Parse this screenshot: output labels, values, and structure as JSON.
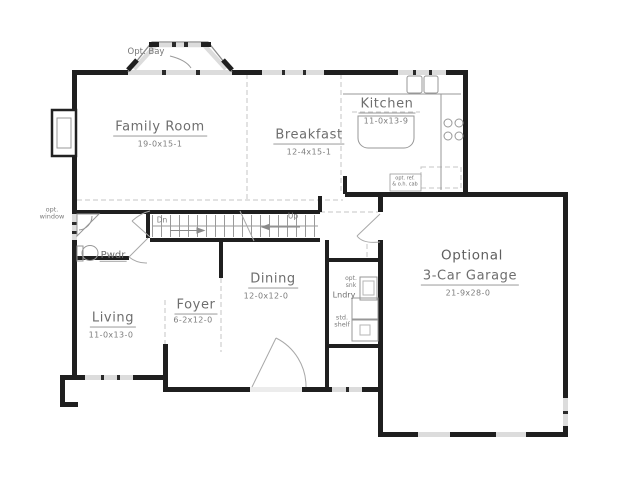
{
  "plan": {
    "rooms": {
      "family": {
        "name": "Family Room",
        "dims": "19-0x15-1"
      },
      "breakfast": {
        "name": "Breakfast",
        "dims": "12-4x15-1"
      },
      "kitchen": {
        "name": "Kitchen",
        "dims": "11-0x13-9"
      },
      "dining": {
        "name": "Dining",
        "dims": "12-0x12-0"
      },
      "living": {
        "name": "Living",
        "dims": "11-0x13-0"
      },
      "foyer": {
        "name": "Foyer",
        "dims": "6-2x12-0"
      },
      "powder": {
        "name": "Pwdr"
      },
      "laundry": {
        "name": "Lndry"
      },
      "garage": {
        "prefix": "Optional",
        "name": "3-Car Garage",
        "dims": "21-9x28-0"
      }
    },
    "annotations": {
      "opt_bay": "Opt. Bay",
      "opt_window": "opt.\nwindow",
      "opt_sink": "opt.\nsnk",
      "std_shelf": "std.\nshelf",
      "opt_ref": "opt. ref.\n& o.h. cab",
      "down": "Dn",
      "up": "Up"
    },
    "colors": {
      "wall": "#1f1f1f",
      "window": "#dcdcdc",
      "fixture_line": "#979797",
      "label_text": "#767676",
      "dashed_line": "#c4c4c4"
    }
  }
}
